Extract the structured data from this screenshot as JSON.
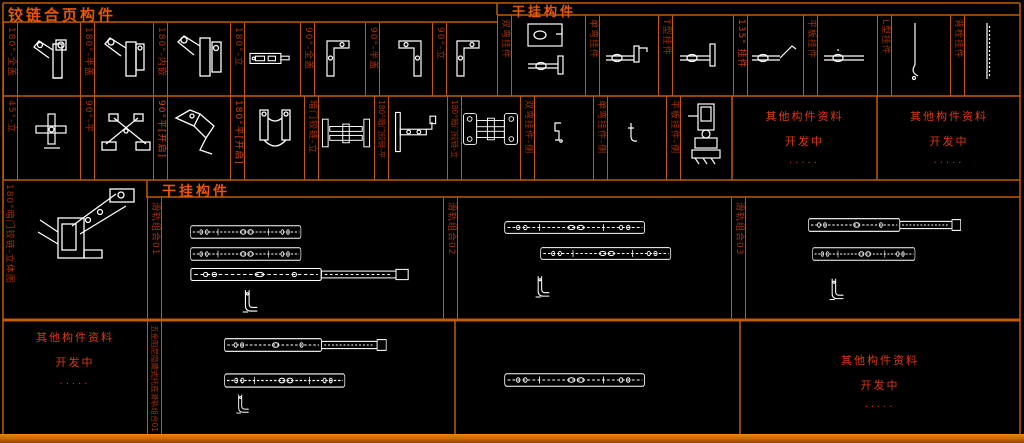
{
  "palette": {
    "background": "#000000",
    "grid": "#c05c04",
    "title_text": "#e85604",
    "label_text": "#a83104",
    "notice_text": "#dc3914",
    "drawing": "#ffffff",
    "bottom_bar": "#c96400"
  },
  "headers": {
    "hinge_section": "铰链合页构件",
    "hanger_section": "干挂构件",
    "rail_section": "干挂构件"
  },
  "hinge_row1": {
    "labels": [
      "180°-全盖",
      "180°-半盖",
      "180°-内嵌",
      "180°-立",
      "90°-全盖",
      "90°-半盖",
      "90°-立"
    ]
  },
  "hanger_row1": {
    "labels": [
      "双弯挂件",
      "单弯挂件",
      "T型挂件",
      "135° 挂件",
      "平板挂件",
      "L型挂件",
      "背栓挂件"
    ]
  },
  "row2": {
    "labels": [
      "45°-立",
      "90°-平",
      "90°平[开启]",
      "180°平[开启]",
      "暗门铰链-立",
      "180°暗门铰链-平",
      "180°暗门铰链-立",
      "双弯挂件-侧",
      "单弯挂件-侧",
      "平板挂件-侧"
    ]
  },
  "rails": {
    "labels": [
      "滑轨组合01",
      "滑轨组合02",
      "滑轨组合03"
    ],
    "bottom_label": "五金阻尼隐藏式托底滑轨组合01"
  },
  "detail": {
    "label": "180°暗门铰链-立体图"
  },
  "notice": {
    "line1": "其他构件资料",
    "line2": "开发中",
    "line3": "·····"
  }
}
